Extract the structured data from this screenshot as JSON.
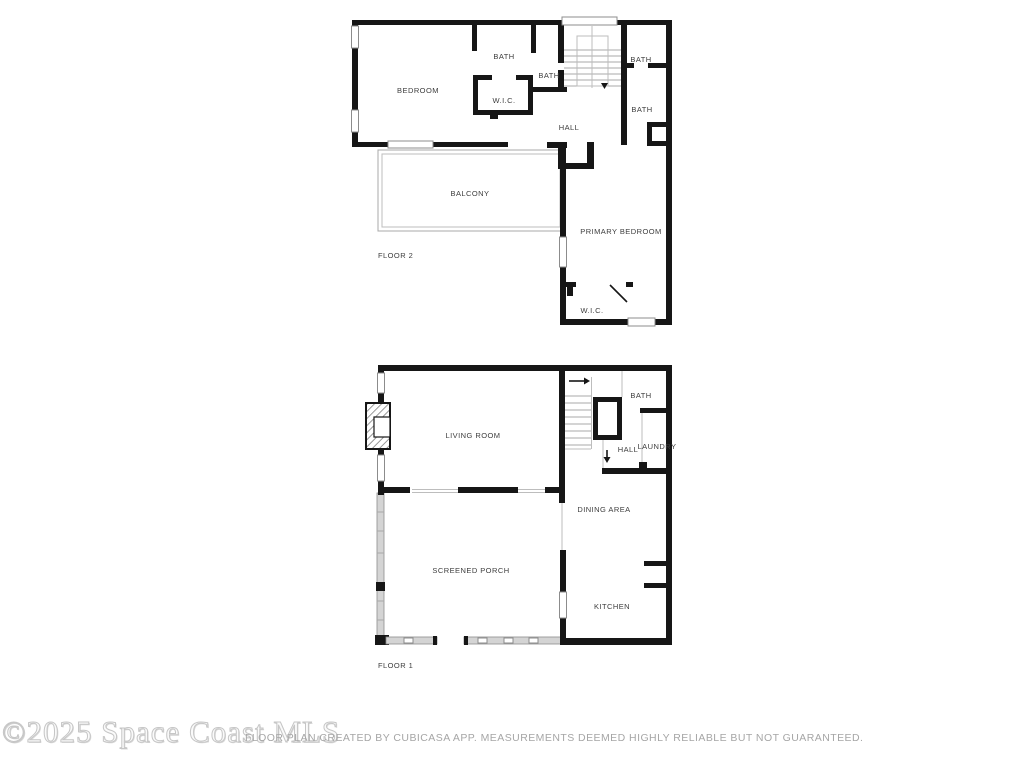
{
  "floor2": {
    "name_label": "FLOOR 2",
    "rooms": {
      "bedroom": "BEDROOM",
      "bath_top": "BATH",
      "bath_mid": "BATH",
      "wic_top": "W.I.C.",
      "hall": "HALL",
      "bath_right_upper": "BATH",
      "bath_right_lower": "BATH",
      "balcony": "BALCONY",
      "primary_bedroom": "PRIMARY BEDROOM",
      "wic_bottom": "W.I.C."
    }
  },
  "floor1": {
    "name_label": "FLOOR 1",
    "rooms": {
      "living_room": "LIVING ROOM",
      "bath": "BATH",
      "hall": "HALL",
      "laundry": "LAUNDRY",
      "dining_area": "DINING AREA",
      "screened_porch": "SCREENED PORCH",
      "kitchen": "KITCHEN"
    }
  },
  "footer": {
    "watermark": "©2025 Space Coast MLS",
    "disclaimer": "FLOOR PLAN CREATED BY CUBICASA APP. MEASUREMENTS DEEMED HIGHLY RELIABLE BUT NOT GUARANTEED."
  },
  "colors": {
    "wall": "#161616",
    "thin_line": "#a8a8a8",
    "window_border": "#8c8c8c",
    "screen_wall": "#d4d4d4",
    "room_label": "#3d3d3d",
    "watermark": "#c6c6c6",
    "disclaimer": "#a6a6a6"
  }
}
